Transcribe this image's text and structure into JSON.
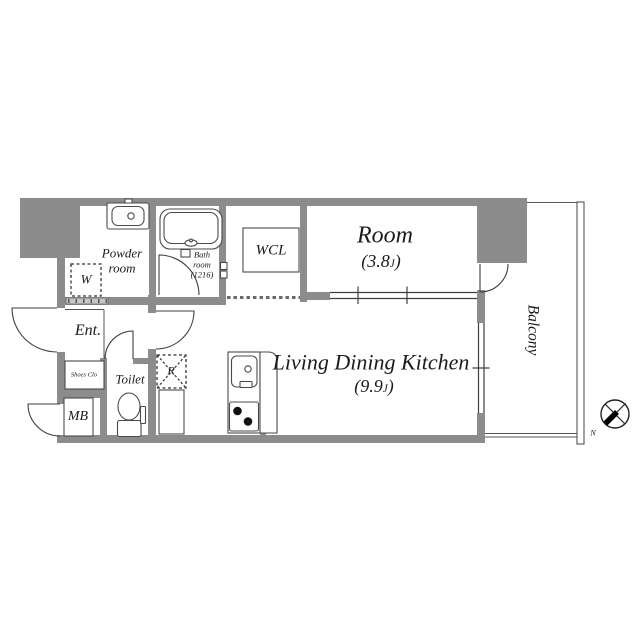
{
  "colors": {
    "wall_gray": "#8c8c8c",
    "line_dark": "#3f3f3f",
    "text": "#1b1b1b",
    "burner_black": "#111111"
  },
  "rooms": {
    "powder": {
      "label": "Powder\nroom"
    },
    "bath": {
      "label": "Bath\nroom\n(1216)"
    },
    "wcl": {
      "label": "WCL"
    },
    "bedroom": {
      "name": "Room",
      "area_open": "(3.8",
      "area_unit": "J",
      "area_close": ")"
    },
    "ldk": {
      "name": "Living Dining Kitchen",
      "area_open": "(9.9",
      "area_unit": "J",
      "area_close": ")"
    },
    "balcony": {
      "label": "Balcony"
    },
    "entrance": {
      "label": "Ent."
    },
    "shoes_closet": {
      "label": "Shoes Clo"
    },
    "toilet": {
      "label": "Toilet"
    },
    "meter_box": {
      "label": "MB"
    }
  },
  "appliance_spaces": {
    "washer": "W",
    "refrigerator": "R"
  },
  "compass": {
    "north_label": "N"
  },
  "icons": {
    "bathtub-icon": "double rounded rectangle with faucet",
    "vanity-sink-icon": "rounded basin with faucet circle",
    "toilet-icon": "ellipse bowl with tank",
    "kitchen-sink-icon": "rounded rectangle with faucet circle",
    "stove-icon": "two black burner dots",
    "compass-icon": "circle with cross and black needle pointing south-west"
  }
}
